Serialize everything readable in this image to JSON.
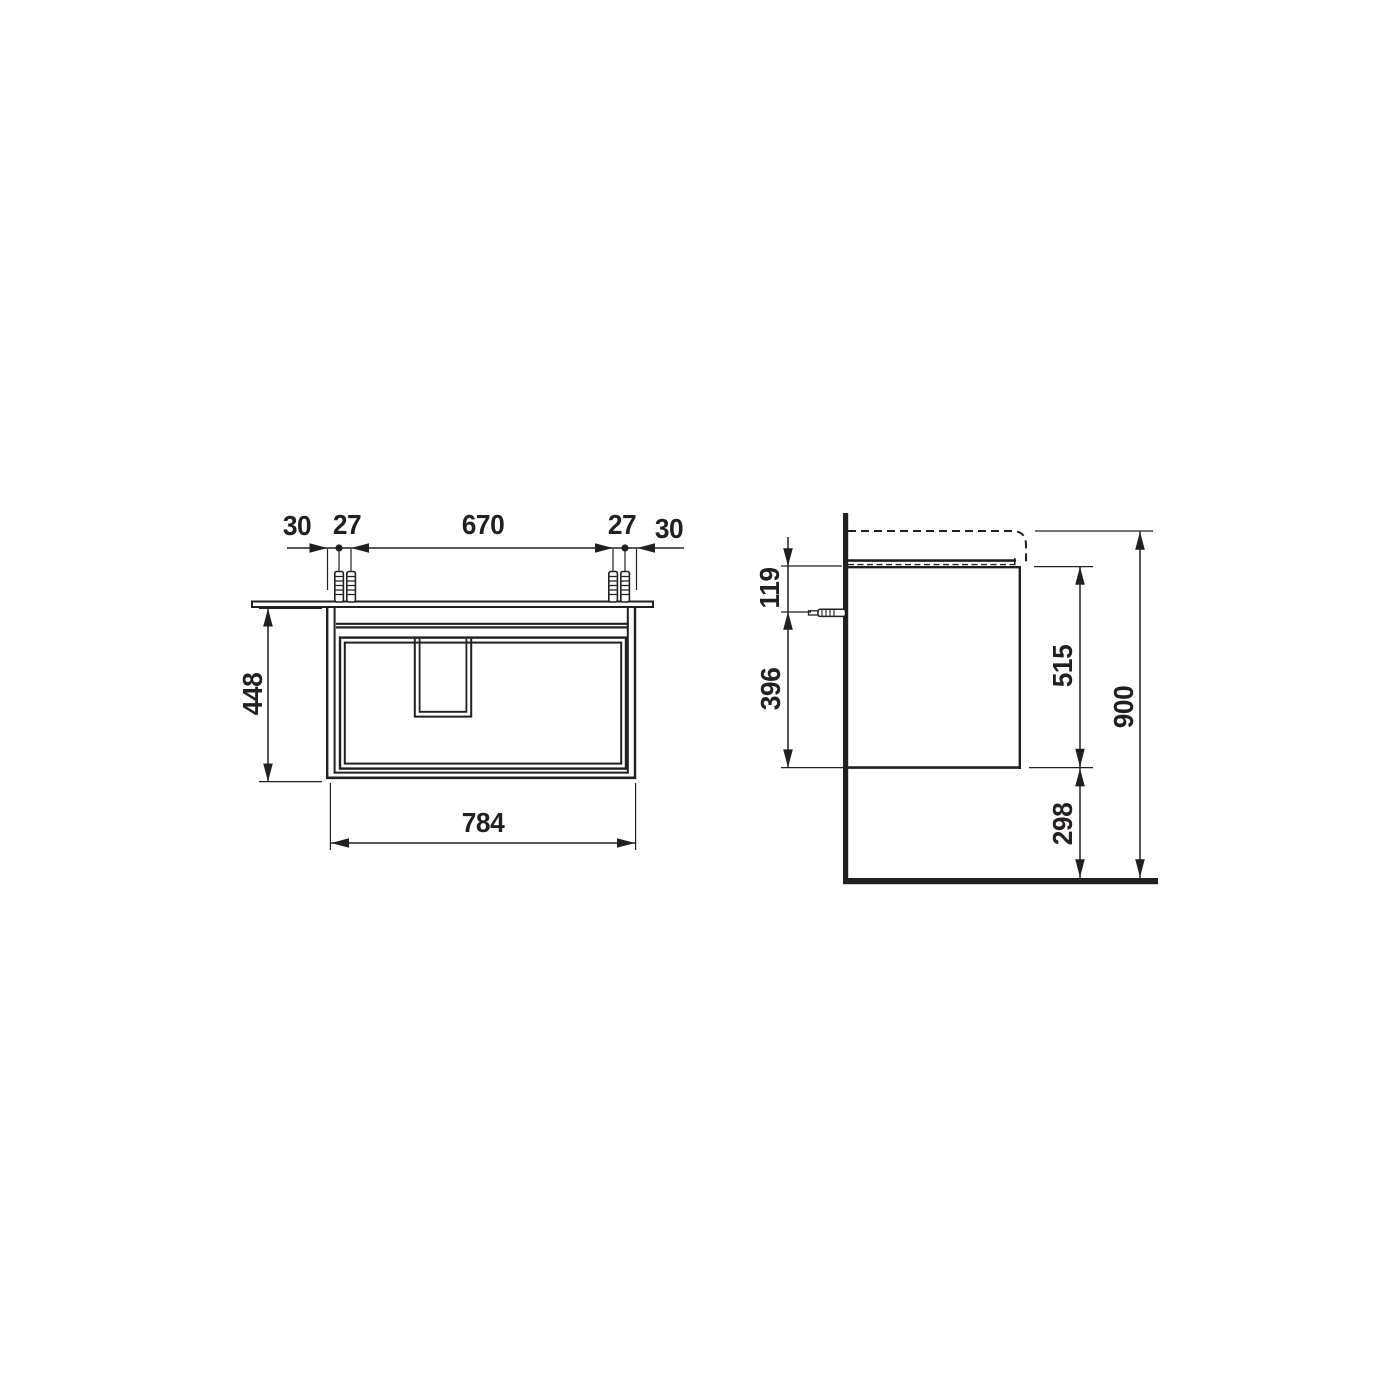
{
  "drawing": {
    "line_color": "#231f20",
    "background_color": "#ffffff",
    "front": {
      "dim_30_left": "30",
      "dim_27_left": "27",
      "dim_670": "670",
      "dim_27_right": "27",
      "dim_30_right": "30",
      "dim_448": "448",
      "dim_784": "784"
    },
    "side": {
      "dim_119": "119",
      "dim_396": "396",
      "dim_515": "515",
      "dim_298": "298",
      "dim_900": "900"
    }
  }
}
